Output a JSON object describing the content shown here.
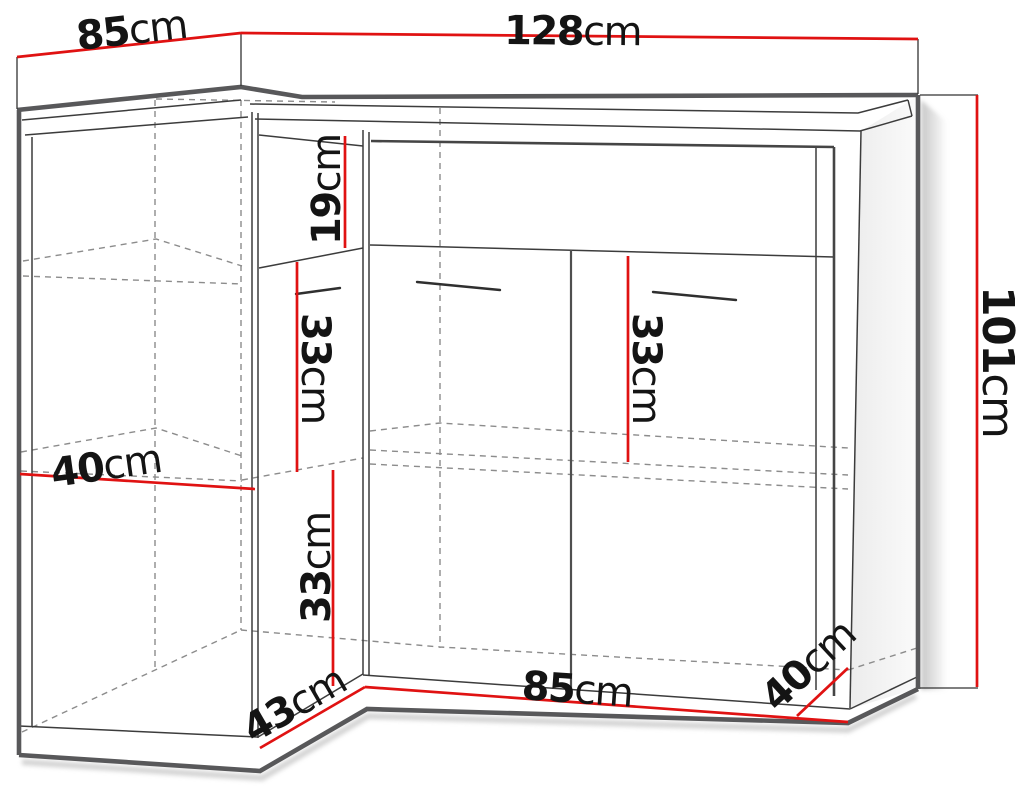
{
  "diagram": {
    "type": "furniture-dimension-drawing",
    "subject": "corner cabinet with angled front, two doors and interior shelves",
    "colors": {
      "dimension_line": "#e01212",
      "outline_thick": "#58585a",
      "outline_thin": "#3c3c3c",
      "hidden_edge_dashed": "#8c8c8c",
      "label_text": "#141414",
      "background": "#ffffff"
    },
    "dimensions": [
      {
        "id": "top-left-width",
        "value": "85",
        "unit": "cm"
      },
      {
        "id": "top-width",
        "value": "128",
        "unit": "cm"
      },
      {
        "id": "height",
        "value": "101",
        "unit": "cm"
      },
      {
        "id": "top-niche-height",
        "value": "19",
        "unit": "cm"
      },
      {
        "id": "corner-upper-shelf-height",
        "value": "33",
        "unit": "cm"
      },
      {
        "id": "front-shelf-height",
        "value": "33",
        "unit": "cm"
      },
      {
        "id": "left-shelf-depth",
        "value": "40",
        "unit": "cm"
      },
      {
        "id": "corner-lower-shelf-height",
        "value": "33",
        "unit": "cm"
      },
      {
        "id": "corner-front-width",
        "value": "43",
        "unit": "cm"
      },
      {
        "id": "front-width",
        "value": "85",
        "unit": "cm"
      },
      {
        "id": "right-side-depth",
        "value": "40",
        "unit": "cm"
      }
    ]
  }
}
